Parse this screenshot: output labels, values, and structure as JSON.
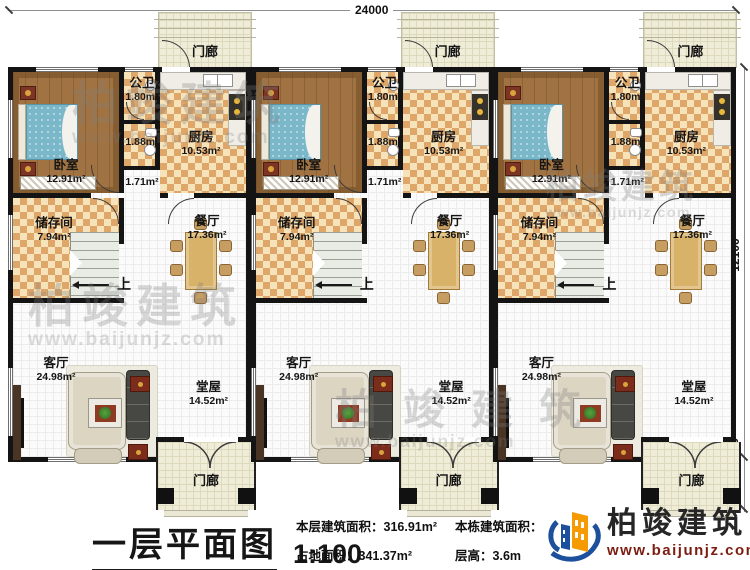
{
  "dimensions": {
    "top": "24000",
    "right": "12100",
    "right_bottom": "1000, 1200"
  },
  "rooms": {
    "porch_top": "门廊",
    "porch_bottom": "门廊",
    "bedroom": {
      "name": "卧室",
      "area": "12.91m²"
    },
    "bath": {
      "name": "公卫",
      "area": "1.80m²"
    },
    "bath2_area": "1.88m²",
    "corridor_area": "1.71m²",
    "kitchen": {
      "name": "厨房",
      "area": "10.53m²"
    },
    "storage": {
      "name": "储存间",
      "area": "7.94m²"
    },
    "dining": {
      "name": "餐厅",
      "area": "17.36m²"
    },
    "living": {
      "name": "客厅",
      "area": "24.98m²"
    },
    "hall": {
      "name": "堂屋",
      "area": "14.52m²"
    },
    "stairs_up": "上"
  },
  "title_block": {
    "title": "一层平面图",
    "scale": "1:100",
    "stats": [
      {
        "label": "本层建筑面积：",
        "value": "316.91m²"
      },
      {
        "label": "占地面积：",
        "value": "341.37m²"
      },
      {
        "label": "本栋建筑面积：",
        "value": ""
      },
      {
        "label": "层高：",
        "value": "3.6m"
      }
    ]
  },
  "brand": {
    "name": "柏竣建筑",
    "website": "www.baijunjz.com"
  },
  "watermark": {
    "text": "柏竣建筑",
    "website": "www.baijunjz.com"
  },
  "colors": {
    "wall": "#141414",
    "checker_dark": "#dfa66a",
    "checker_light": "#f6e3ba",
    "wood": "#a27342",
    "brand_orange": "#f59a00",
    "brand_blue": "#1c4f9c",
    "brand_red": "#7c1d12"
  }
}
